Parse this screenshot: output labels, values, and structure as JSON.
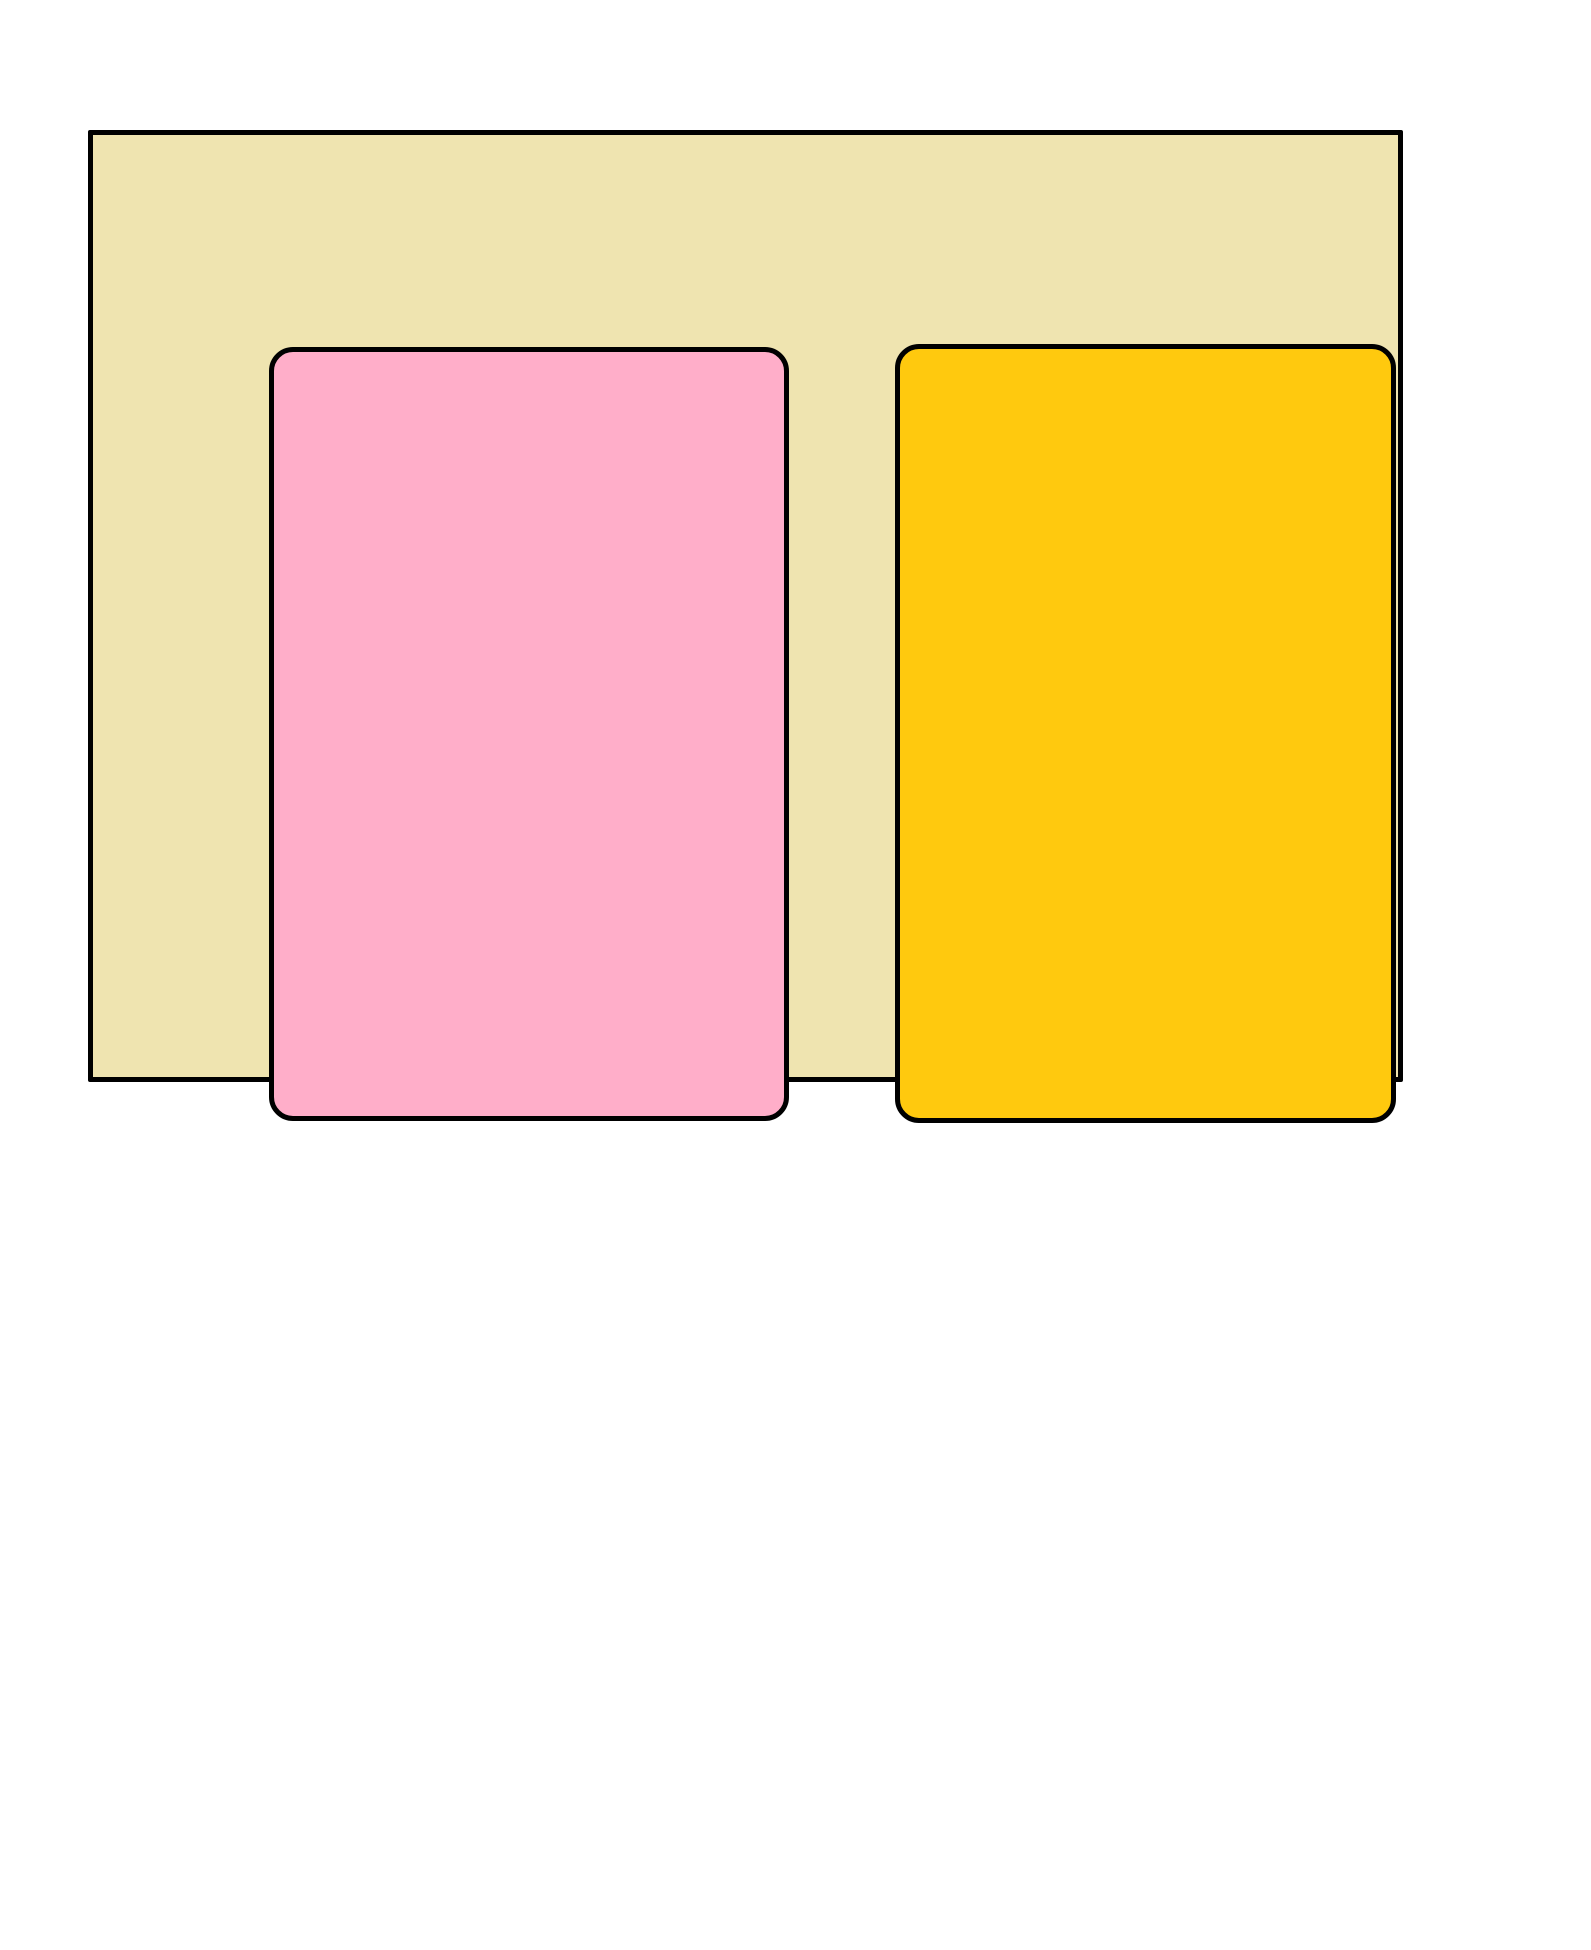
{
  "canvas": {
    "background_color": "#FFFFFF"
  },
  "drawing": {
    "outer_rectangle": {
      "shape": "rectangle",
      "fill": "#EFE4B0",
      "stroke": "#000000",
      "stroke_width_px": 5
    },
    "left_rounded_rectangle": {
      "shape": "rounded-rectangle",
      "fill": "#FFAEC9",
      "stroke": "#000000",
      "stroke_width_px": 5
    },
    "right_rounded_rectangle": {
      "shape": "rounded-rectangle",
      "fill": "#FFC90E",
      "stroke": "#000000",
      "stroke_width_px": 5
    }
  }
}
